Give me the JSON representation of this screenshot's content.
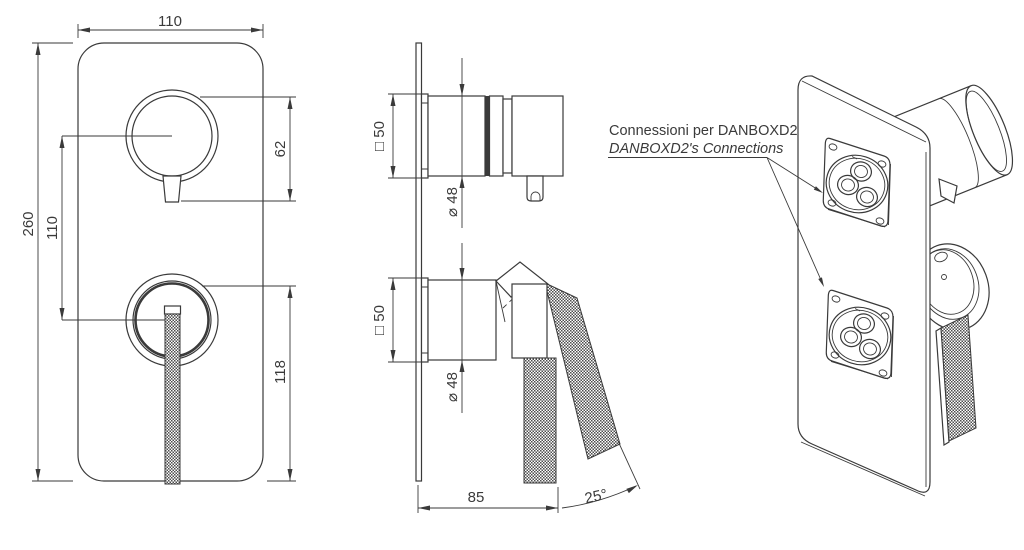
{
  "annotation": {
    "line1": "Connessioni per DANBOXD2",
    "line2": "DANBOXD2's Connections"
  },
  "front_view": {
    "plate_width": "110",
    "plate_height": "260",
    "knob_spacing": "110",
    "top_knob_extent": "62",
    "lever_extent": "118"
  },
  "side_view": {
    "top_flange": "□ 50",
    "top_diameter": "⌀ 48",
    "bottom_flange": "□ 50",
    "bottom_diameter": "⌀ 48",
    "depth": "85",
    "lever_angle": "25°"
  },
  "colors": {
    "line": "#3a3a3a",
    "background": "#ffffff"
  }
}
